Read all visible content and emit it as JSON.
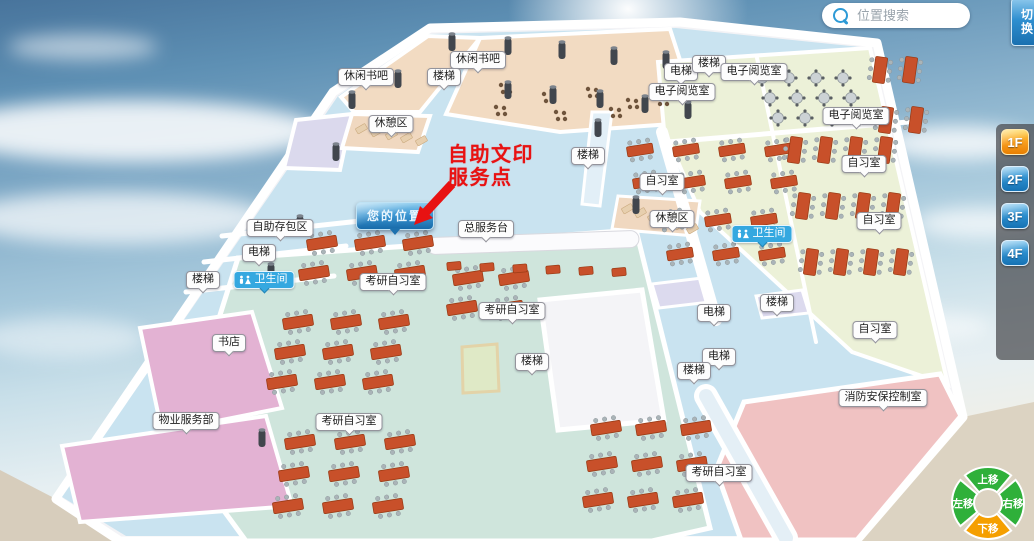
{
  "search": {
    "placeholder": "位置搜索"
  },
  "switch_button": {
    "label": "切换"
  },
  "floor_selector": {
    "floors": [
      "1F",
      "2F",
      "3F",
      "4F"
    ],
    "active": "1F"
  },
  "compass": {
    "up": "上移",
    "right": "右移",
    "down": "下移",
    "left": "左移",
    "colors": {
      "up": "#2fb03a",
      "right": "#2fb03a",
      "down": "#f59f00",
      "left": "#2fb03a"
    }
  },
  "annotation": {
    "line1": "自助文印",
    "line2": "服务点",
    "color": "#e81212"
  },
  "you_marker": {
    "label": "您的位置",
    "x": 390,
    "y": 215
  },
  "colors": {
    "accent_blue": "#2f8fd0",
    "active_floor_orange": "#f89e1e",
    "restroom_badge_blue": "#35a8e0",
    "annotation_red": "#e81212"
  },
  "map_labels": [
    {
      "text": "休闲书吧",
      "x": 366,
      "y": 77,
      "kind": "plain"
    },
    {
      "text": "休闲书吧",
      "x": 478,
      "y": 60,
      "kind": "plain"
    },
    {
      "text": "楼梯",
      "x": 444,
      "y": 77,
      "kind": "plain"
    },
    {
      "text": "休憩区",
      "x": 391,
      "y": 124,
      "kind": "plain"
    },
    {
      "text": "电梯",
      "x": 681,
      "y": 72,
      "kind": "plain"
    },
    {
      "text": "楼梯",
      "x": 709,
      "y": 64,
      "kind": "plain"
    },
    {
      "text": "电子阅览室",
      "x": 754,
      "y": 72,
      "kind": "plain"
    },
    {
      "text": "电子阅览室",
      "x": 682,
      "y": 92,
      "kind": "plain"
    },
    {
      "text": "电子阅览室",
      "x": 856,
      "y": 116,
      "kind": "plain"
    },
    {
      "text": "楼梯",
      "x": 588,
      "y": 156,
      "kind": "plain"
    },
    {
      "text": "自习室",
      "x": 662,
      "y": 182,
      "kind": "plain"
    },
    {
      "text": "自习室",
      "x": 864,
      "y": 164,
      "kind": "plain"
    },
    {
      "text": "休憩区",
      "x": 672,
      "y": 219,
      "kind": "plain"
    },
    {
      "text": "自习室",
      "x": 879,
      "y": 221,
      "kind": "plain"
    },
    {
      "text": "总服务台",
      "x": 486,
      "y": 229,
      "kind": "plain"
    },
    {
      "text": "自助存包区",
      "x": 280,
      "y": 228,
      "kind": "plain"
    },
    {
      "text": "电梯",
      "x": 259,
      "y": 253,
      "kind": "plain"
    },
    {
      "text": "楼梯",
      "x": 203,
      "y": 280,
      "kind": "plain"
    },
    {
      "text": "卫生间",
      "x": 264,
      "y": 280,
      "kind": "wc"
    },
    {
      "text": "卫生间",
      "x": 762,
      "y": 234,
      "kind": "wc"
    },
    {
      "text": "书店",
      "x": 229,
      "y": 343,
      "kind": "plain"
    },
    {
      "text": "物业服务部",
      "x": 186,
      "y": 421,
      "kind": "plain"
    },
    {
      "text": "考研自习室",
      "x": 393,
      "y": 282,
      "kind": "plain"
    },
    {
      "text": "考研自习室",
      "x": 512,
      "y": 311,
      "kind": "plain"
    },
    {
      "text": "楼梯",
      "x": 532,
      "y": 362,
      "kind": "plain"
    },
    {
      "text": "考研自习室",
      "x": 349,
      "y": 422,
      "kind": "plain"
    },
    {
      "text": "电梯",
      "x": 714,
      "y": 313,
      "kind": "plain"
    },
    {
      "text": "楼梯",
      "x": 777,
      "y": 303,
      "kind": "plain"
    },
    {
      "text": "电梯",
      "x": 719,
      "y": 357,
      "kind": "plain"
    },
    {
      "text": "楼梯",
      "x": 694,
      "y": 371,
      "kind": "plain"
    },
    {
      "text": "自习室",
      "x": 875,
      "y": 330,
      "kind": "plain"
    },
    {
      "text": "消防安保控制室",
      "x": 883,
      "y": 398,
      "kind": "plain"
    },
    {
      "text": "考研自习室",
      "x": 719,
      "y": 473,
      "kind": "plain"
    }
  ]
}
